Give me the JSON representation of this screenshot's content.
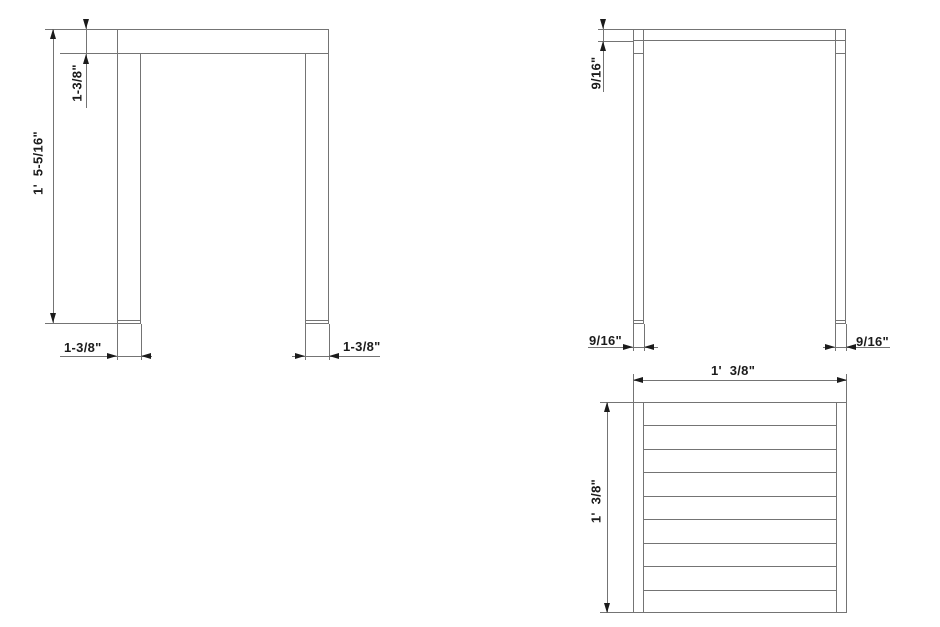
{
  "colors": {
    "background": "#ffffff",
    "line": "#747474",
    "ink": "#1b1b1b"
  },
  "views": {
    "front": {
      "dims": {
        "overall_height": "1'  5-5/16\"",
        "top_thickness": "1-3/8\"",
        "left_leg_width": "1-3/8\"",
        "right_leg_width": "1-3/8\""
      }
    },
    "side": {
      "dims": {
        "top_thickness": "9/16\"",
        "left_leg_depth": "9/16\"",
        "right_leg_depth": "9/16\""
      }
    },
    "top": {
      "slat_rows": 9,
      "dims": {
        "width": "1'  3/8\"",
        "depth": "1'  3/8\""
      }
    }
  }
}
